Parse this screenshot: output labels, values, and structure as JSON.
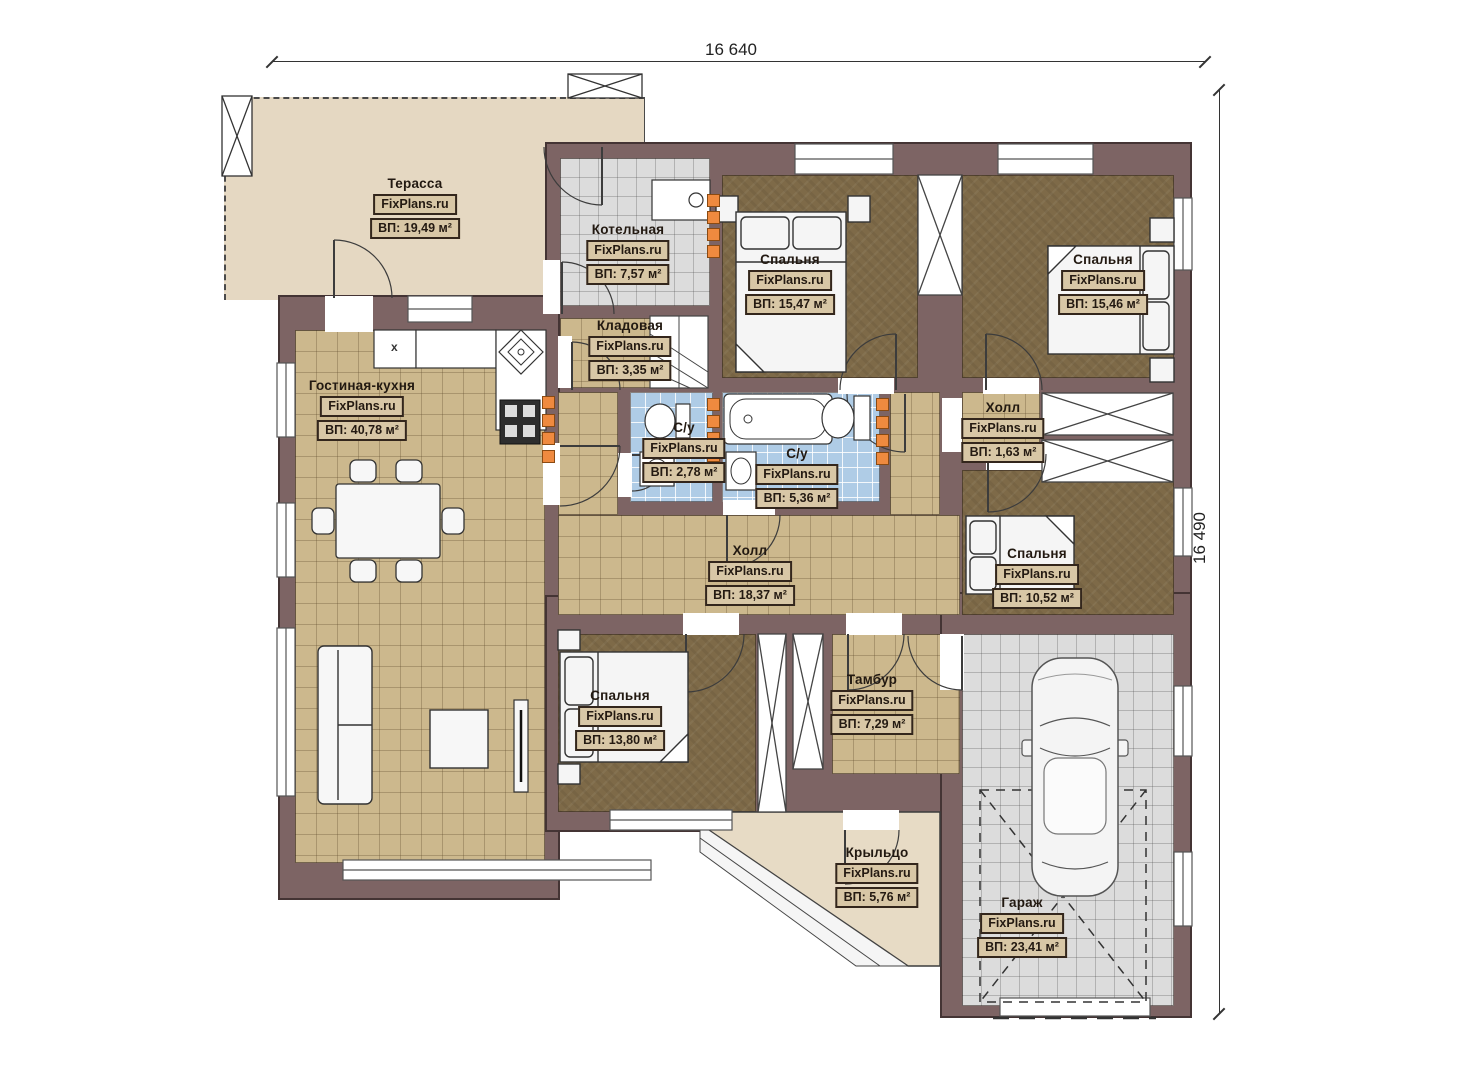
{
  "dimensions": {
    "top": "16 640",
    "right": "16 490"
  },
  "rooms": [
    {
      "name": "Терасса",
      "brand": "FixPlans.ru",
      "area": "ВП: 19,49 м²"
    },
    {
      "name": "Котельная",
      "brand": "FixPlans.ru",
      "area": "ВП: 7,57 м²"
    },
    {
      "name": "Спальня",
      "brand": "FixPlans.ru",
      "area": "ВП: 15,47 м²"
    },
    {
      "name": "Спальня",
      "brand": "FixPlans.ru",
      "area": "ВП: 15,46 м²"
    },
    {
      "name": "Кладовая",
      "brand": "FixPlans.ru",
      "area": "ВП: 3,35 м²"
    },
    {
      "name": "Гостиная-кухня",
      "brand": "FixPlans.ru",
      "area": "ВП: 40,78 м²"
    },
    {
      "name": "С/у",
      "brand": "FixPlans.ru",
      "area": "ВП: 2,78 м²"
    },
    {
      "name": "С/у",
      "brand": "FixPlans.ru",
      "area": "ВП: 5,36 м²"
    },
    {
      "name": "Холл",
      "brand": "FixPlans.ru",
      "area": "ВП: 1,63 м²"
    },
    {
      "name": "Холл",
      "brand": "FixPlans.ru",
      "area": "ВП: 18,37 м²"
    },
    {
      "name": "Спальня",
      "brand": "FixPlans.ru",
      "area": "ВП: 10,52 м²"
    },
    {
      "name": "Спальня",
      "brand": "FixPlans.ru",
      "area": "ВП: 13,80 м²"
    },
    {
      "name": "Тамбур",
      "brand": "FixPlans.ru",
      "area": "ВП: 7,29 м²"
    },
    {
      "name": "Крыльцо",
      "brand": "FixPlans.ru",
      "area": "ВП: 5,76 м²"
    },
    {
      "name": "Гараж",
      "brand": "FixPlans.ru",
      "area": "ВП: 23,41 м²"
    }
  ],
  "kitchen": {
    "unit_label": "x"
  },
  "colors": {
    "wall": "#7d6464",
    "terrace": "#e5d8c2",
    "tan": "#ccb88d",
    "brown": "#7e6a48",
    "blue": "#afcce6",
    "gray": "#dcdcdc",
    "vent": "#ef8a3f",
    "label_box": "#d8c7a6"
  }
}
